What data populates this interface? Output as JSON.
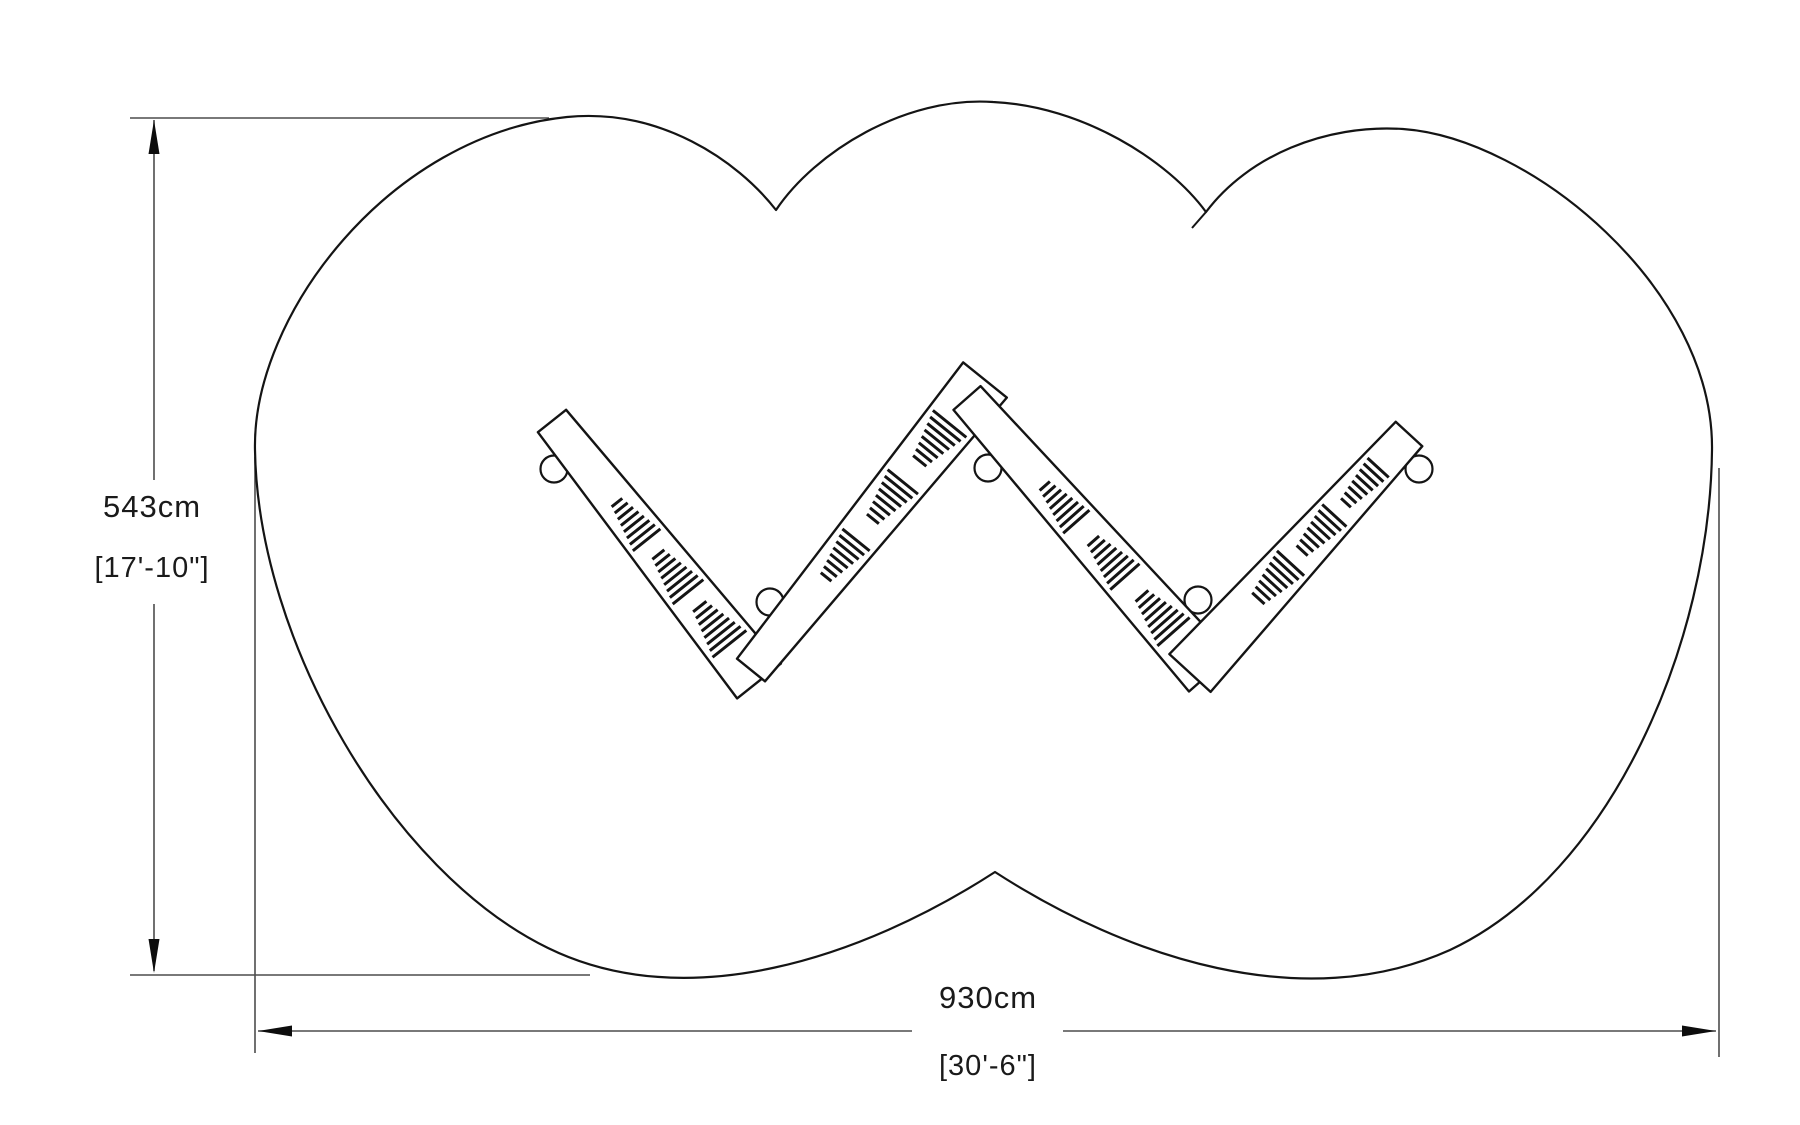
{
  "drawing_title": "double-heart playground plan view",
  "dimensions": {
    "vertical": {
      "metric": "543cm",
      "imperial": "[17'-10\"]"
    },
    "horizontal": {
      "metric": "930cm",
      "imperial": "[30'-6\"]"
    }
  },
  "colors": {
    "background": "#ffffff",
    "outline": "#141414",
    "structure": "#141414",
    "dimension": "#4d4d4d",
    "arrow": "#0d0d0d",
    "text": "#1a1a1a"
  },
  "geometry": {
    "outline_path": "M 255 450 C 252 315 390 135 567 117 C 660 108 737 160 776 210 C 815 152 905 96 993 102 C 1082 106 1168 160 1206 212 C 1248 156 1325 124 1403 129 C 1530 138 1714 288 1712 450 C 1710 642 1612 874 1450 950 C 1303 1016 1128 958 995 872 C 862 958 687 1016 548 948 C 392 872 258 642 255 450 Z",
    "overlap_tail": [
      1206,
      212,
      1192,
      228
    ],
    "beams": [
      {
        "p1": [
          552,
          421
        ],
        "p2": [
          759,
          681
        ],
        "w1": 36,
        "w2": 56
      },
      {
        "p1": [
          751,
          670
        ],
        "p2": [
          985,
          380
        ],
        "w1": 36,
        "w2": 56
      },
      {
        "p1": [
          967,
          398
        ],
        "p2": [
          1210,
          673
        ],
        "w1": 36,
        "w2": 56
      },
      {
        "p1": [
          1409,
          434
        ],
        "p2": [
          1190,
          673
        ],
        "w1": 36,
        "w2": 56
      }
    ],
    "wedge_ts": [
      0.38,
      0.58,
      0.78
    ],
    "wedge": {
      "slats": 8,
      "spacing": 6.8,
      "slat_width": 3.0,
      "back_offset": 22
    },
    "balls": [
      [
        554,
        469
      ],
      [
        770,
        602
      ],
      [
        988,
        468
      ],
      [
        1198,
        600
      ],
      [
        1419,
        469
      ]
    ],
    "ball_radius": 13.5,
    "vdim": {
      "line_x": 154,
      "segments": [
        [
          120,
          480
        ],
        [
          604,
          971
        ]
      ],
      "ext_top": [
        130,
        118,
        549,
        118
      ],
      "ext_bottom": [
        130,
        975,
        590,
        975
      ],
      "arrow_up_tip": [
        154,
        120
      ],
      "arrow_down_tip": [
        154,
        973
      ],
      "metric_pos": [
        152,
        517
      ],
      "imperial_pos": [
        152,
        577
      ]
    },
    "hdim": {
      "line_y": 1031,
      "segments": [
        [
          258,
          912
        ],
        [
          1063,
          1716
        ]
      ],
      "ext_left": [
        255,
        457,
        255,
        1053
      ],
      "ext_right": [
        1719,
        468,
        1719,
        1057
      ],
      "arrow_left_tip": [
        258,
        1031
      ],
      "arrow_right_tip": [
        1716,
        1031
      ],
      "metric_pos": [
        988,
        1008
      ],
      "imperial_pos": [
        988,
        1075
      ]
    },
    "arrow": {
      "length": 34,
      "half_width": 5.5
    }
  }
}
